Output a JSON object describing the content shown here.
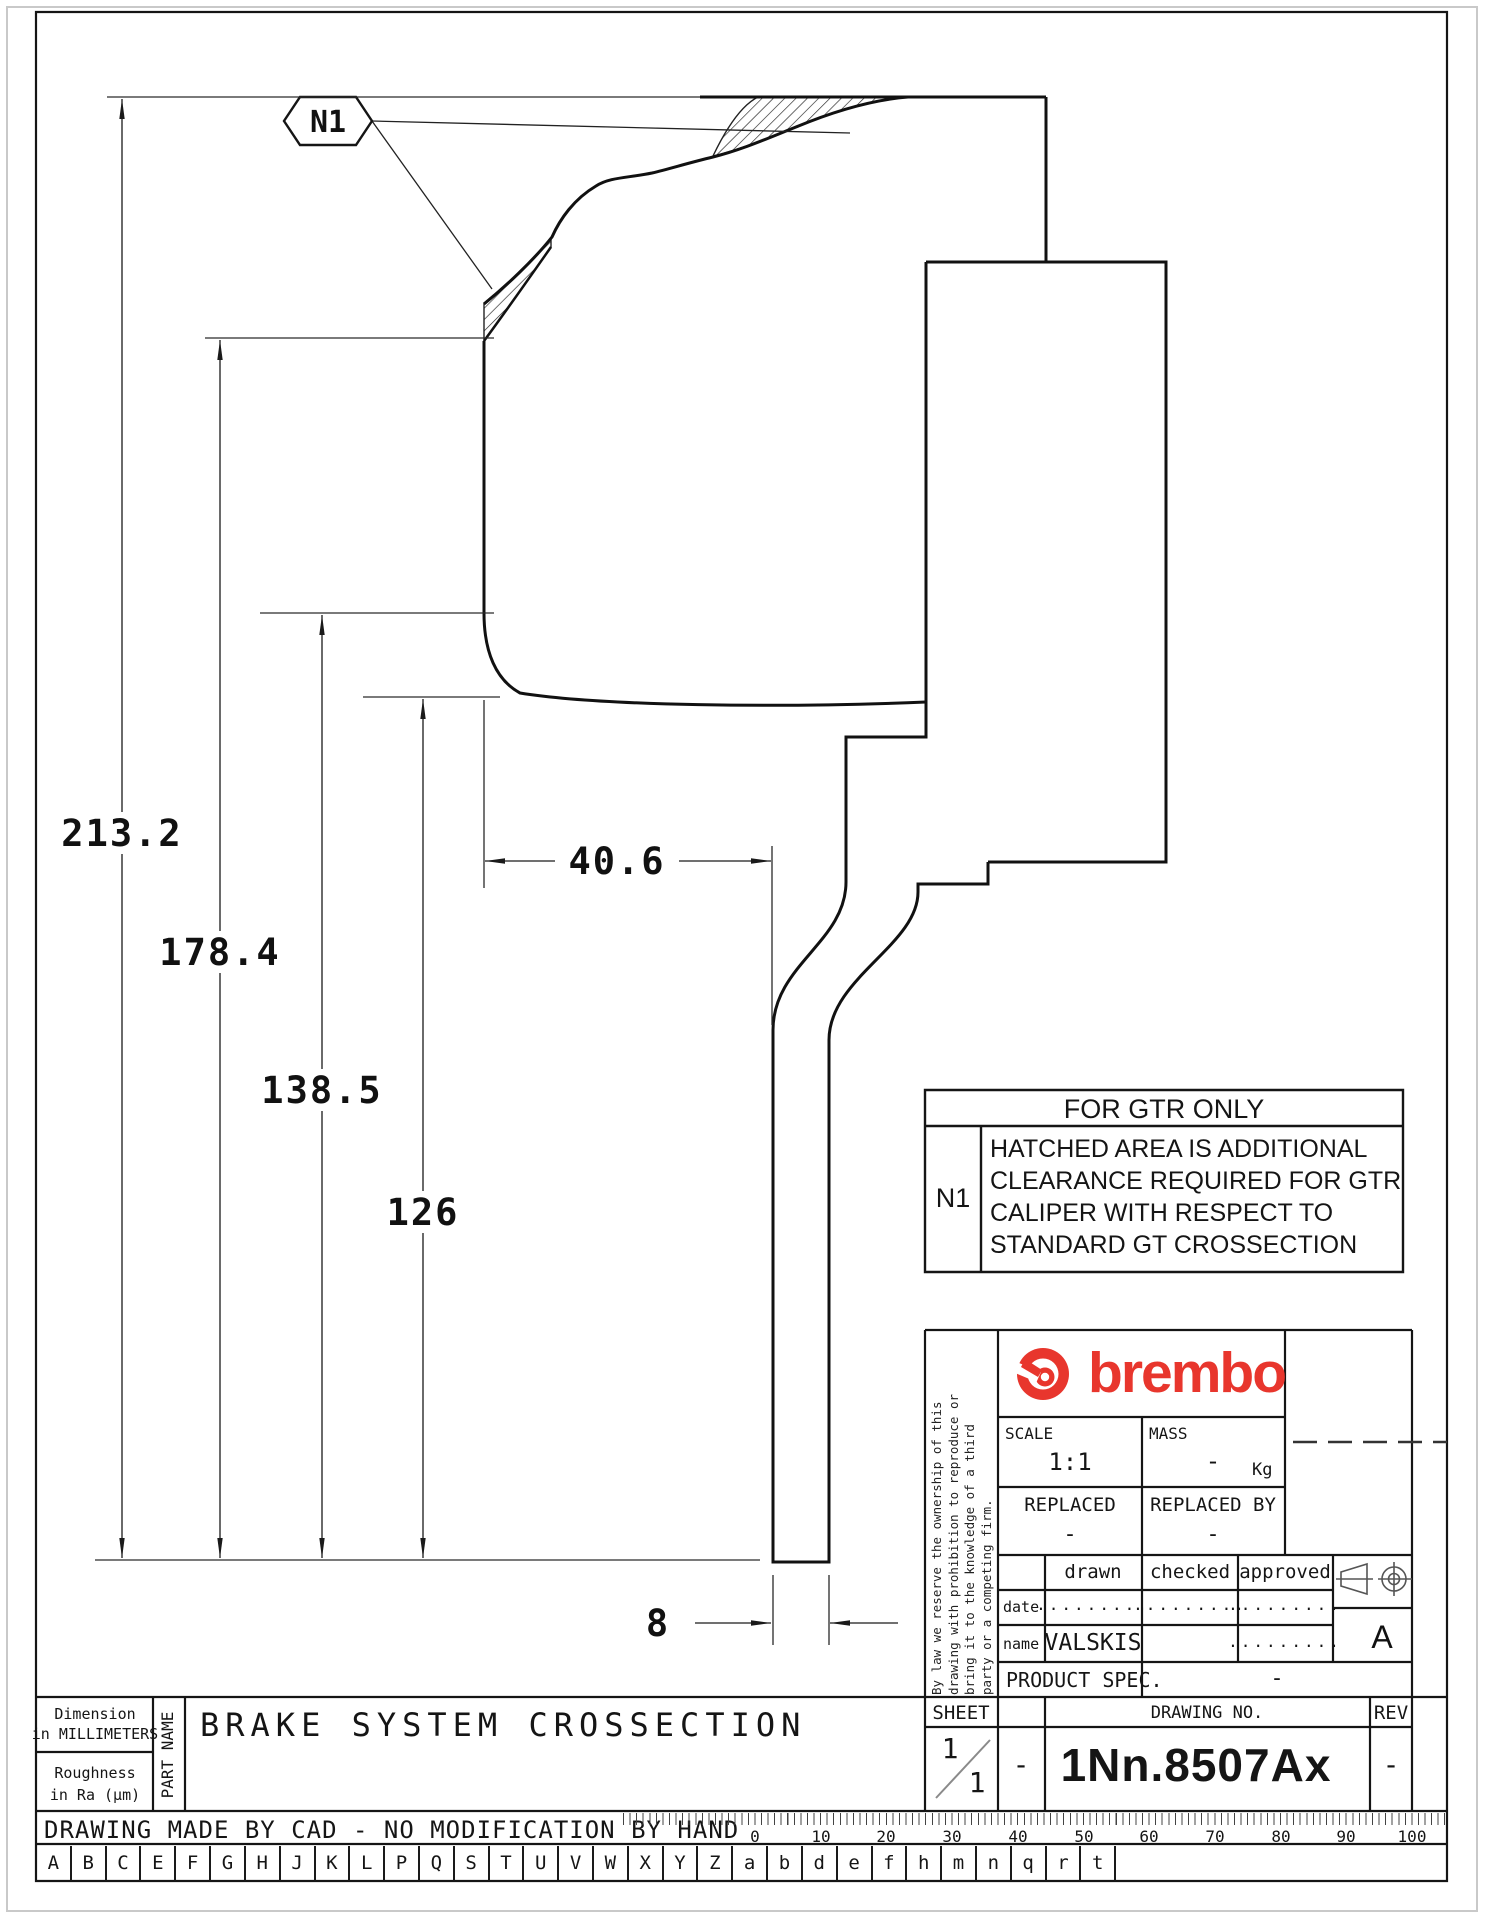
{
  "drawing": {
    "callout_label": "N1",
    "dim_overall": "213.2",
    "dim_2": "178.4",
    "dim_3": "138.5",
    "dim_4": "126",
    "dim_width": "40.6",
    "dim_thickness": "8"
  },
  "gtr_note": {
    "title": "FOR GTR ONLY",
    "ref": "N1",
    "lines": [
      "HATCHED AREA IS ADDITIONAL",
      "CLEARANCE REQUIRED FOR GTR",
      "CALIPER WITH RESPECT TO",
      "STANDARD GT CROSSECTION"
    ]
  },
  "title_block": {
    "disclaimer": [
      "By law we reserve the ownership of this",
      "drawing with prohibition to reproduce or",
      "bring it to the knowledge of a third",
      "party or a competing firm."
    ],
    "brand": "brembo",
    "scale_label": "SCALE",
    "scale_value": "1:1",
    "mass_label": "MASS",
    "mass_value": "-",
    "mass_unit": "Kg",
    "replaced_label": "REPLACED",
    "replaced_value": "-",
    "replaced_by_label": "REPLACED BY",
    "replaced_by_value": "-",
    "drawn_label": "drawn",
    "checked_label": "checked",
    "approved_label": "approved",
    "date_label": "date",
    "name_label": "name",
    "date_drawn": ".........",
    "date_checked": ".........",
    "date_approved": ".........",
    "name_drawn": "VALSKIS",
    "name_approved": ".........",
    "product_spec_label": "PRODUCT SPEC.",
    "product_spec_value": "-",
    "sheet_label": "SHEET",
    "sheet_value_num": "1",
    "sheet_value_den": "1",
    "sheet_aux": "-",
    "drawing_no_label": "DRAWING NO.",
    "drawing_no": "1Nn.8507Ax",
    "rev_label": "REV",
    "rev_value": "-",
    "format_letter": "A"
  },
  "footer": {
    "dimension_note_line1": "Dimension",
    "dimension_note_line2": "in MILLIMETERS",
    "roughness_note_line1": "Roughness",
    "roughness_note_line2": "in Ra (µm)",
    "part_name_label": "PART NAME",
    "part_name": "BRAKE SYSTEM CROSSECTION",
    "cad_note": "DRAWING MADE BY CAD - NO MODIFICATION BY HAND",
    "ruler_labels": [
      "0",
      "10",
      "20",
      "30",
      "40",
      "50",
      "60",
      "70",
      "80",
      "90",
      "100"
    ],
    "letters": [
      "A",
      "B",
      "C",
      "E",
      "F",
      "G",
      "H",
      "J",
      "K",
      "L",
      "P",
      "Q",
      "S",
      "T",
      "U",
      "V",
      "W",
      "X",
      "Y",
      "Z",
      "a",
      "b",
      "d",
      "e",
      "f",
      "h",
      "m",
      "n",
      "q",
      "r",
      "t"
    ]
  },
  "colors": {
    "brand_red": "#e8362d",
    "line": "#1a1a1a"
  }
}
